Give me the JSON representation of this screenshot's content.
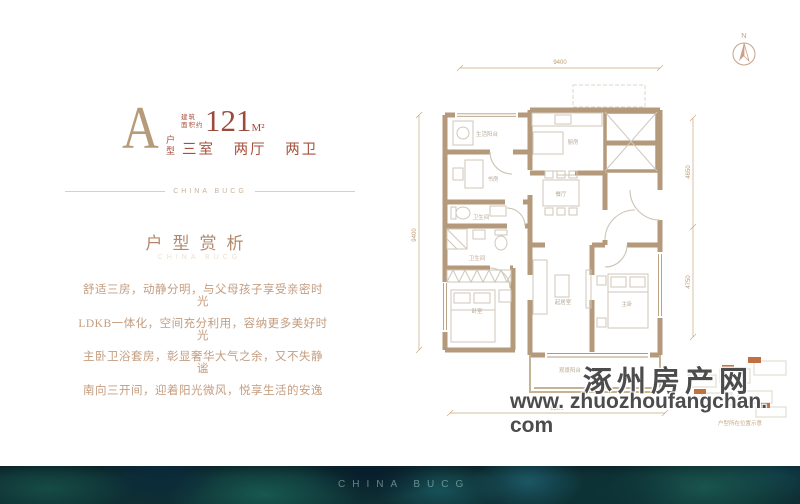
{
  "header": {
    "plan_letter": "A",
    "plan_type_label": "户型",
    "area_label_line1": "建筑",
    "area_label_line2": "面积约",
    "area_value": "121",
    "area_unit": "M²",
    "layout_rooms": "三室",
    "layout_halls": "两厅",
    "layout_baths": "两卫",
    "divider_brand": "CHINA BUCG"
  },
  "analysis": {
    "title": "户型赏析",
    "ghost_brand": "CHINA BUCG",
    "lines": [
      "舒适三房，动静分明，与父母孩子享受亲密时光",
      "LDKB一体化，空间充分利用，容纳更多美好时光",
      "主卧卫浴套房，彰显奢华大气之余，又不失静谧",
      "南向三开间，迎着阳光微风，悦享生活的安逸"
    ]
  },
  "floorplan": {
    "compass_label": "N",
    "rooms": [
      {
        "label": "生活阳台"
      },
      {
        "label": "书房"
      },
      {
        "label": "厨房"
      },
      {
        "label": "餐厅"
      },
      {
        "label": "卫生间"
      },
      {
        "label": "卫生间"
      },
      {
        "label": "卧室"
      },
      {
        "label": "起居室"
      },
      {
        "label": "主卧"
      },
      {
        "label": "观景阳台"
      }
    ],
    "dims": {
      "top": "9400",
      "left": "9400",
      "right_upper": "4650",
      "right_lower": "4750",
      "bottom": "9300"
    }
  },
  "keyplan": {
    "caption": "户型所在位置示意"
  },
  "watermark": {
    "site_name": "涿州房产网",
    "site_url": "www. zhuozhoufangchan. com"
  },
  "footer": {
    "brand": "CHINA BUCG"
  },
  "colors": {
    "accent_tan": "#b59b79",
    "accent_red": "#a8503d",
    "wall": "#b49a7a",
    "band_teal": "#0e2f33",
    "watermark_gray": "#4c4c4c"
  }
}
